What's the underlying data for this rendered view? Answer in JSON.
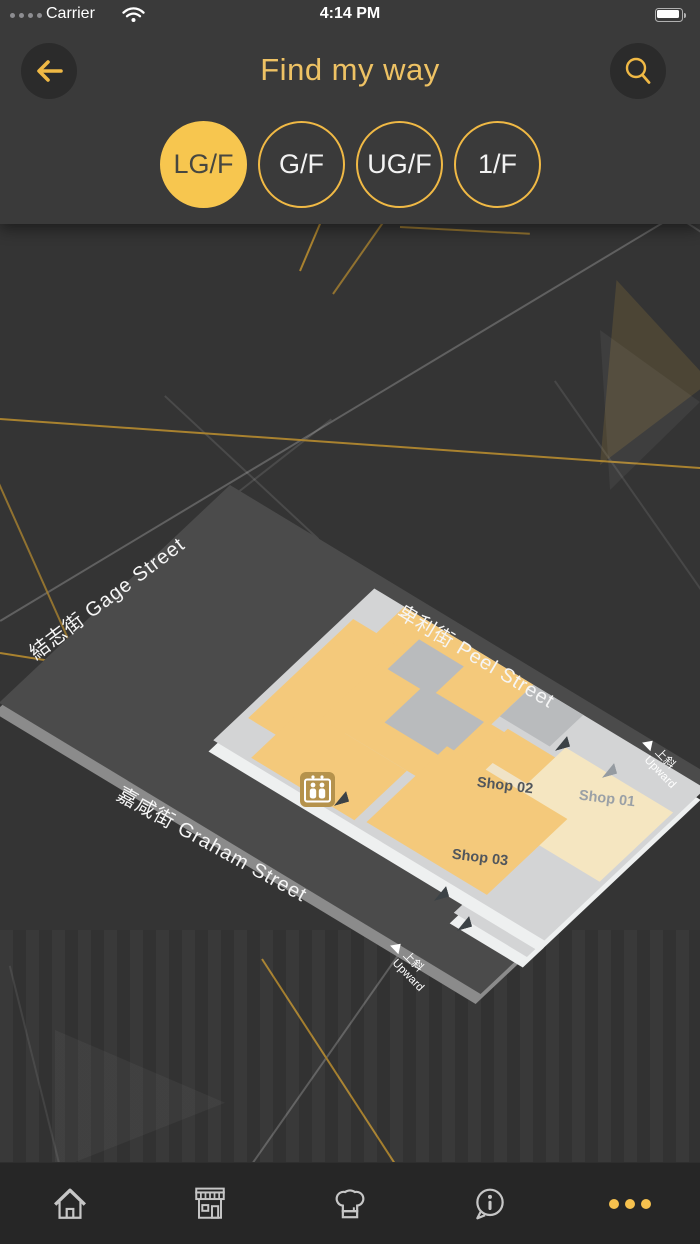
{
  "status_bar": {
    "carrier": "Carrier",
    "time": "4:14 PM",
    "signal_icon": "signal-dots",
    "wifi_icon": "wifi",
    "battery_icon": "battery-full"
  },
  "header": {
    "title": "Find my way",
    "back_icon": "arrow-left",
    "search_icon": "magnifier"
  },
  "floor_selector": {
    "floors": [
      {
        "label": "LG/F",
        "selected": true
      },
      {
        "label": "G/F",
        "selected": false
      },
      {
        "label": "UG/F",
        "selected": false
      },
      {
        "label": "1/F",
        "selected": false
      }
    ]
  },
  "map": {
    "streets": [
      {
        "label": "結志街 Gage Street"
      },
      {
        "label": "卑利街 Peel Street"
      },
      {
        "label": "嘉咸街 Graham Street"
      }
    ],
    "shops": [
      {
        "label": "Shop 01"
      },
      {
        "label": "Shop 02"
      },
      {
        "label": "Shop 03"
      }
    ],
    "ramps": [
      {
        "zh": "上斜",
        "en": "Upward"
      },
      {
        "zh": "上斜",
        "en": "Upward"
      }
    ],
    "lift_icon": "elevator-lift",
    "colors": {
      "street_plate": "#4b4b4b",
      "floor_base": "#d3d4d5",
      "shop_yellow": "#f4c97b",
      "shop_cream": "#f5e6c1",
      "block_gray": "#b9bbbd"
    }
  },
  "tab_bar": {
    "items": [
      {
        "icon": "home"
      },
      {
        "icon": "storefront"
      },
      {
        "icon": "chef-hat"
      },
      {
        "icon": "info-bubble"
      },
      {
        "icon": "more-dots"
      }
    ]
  },
  "colors": {
    "accent_gold": "#f0b945",
    "selected_floor_fill": "#f7c64f",
    "title_gold": "#eec264",
    "background": "#343434",
    "header": "#3a3a3a",
    "tab_bar": "#262626"
  }
}
